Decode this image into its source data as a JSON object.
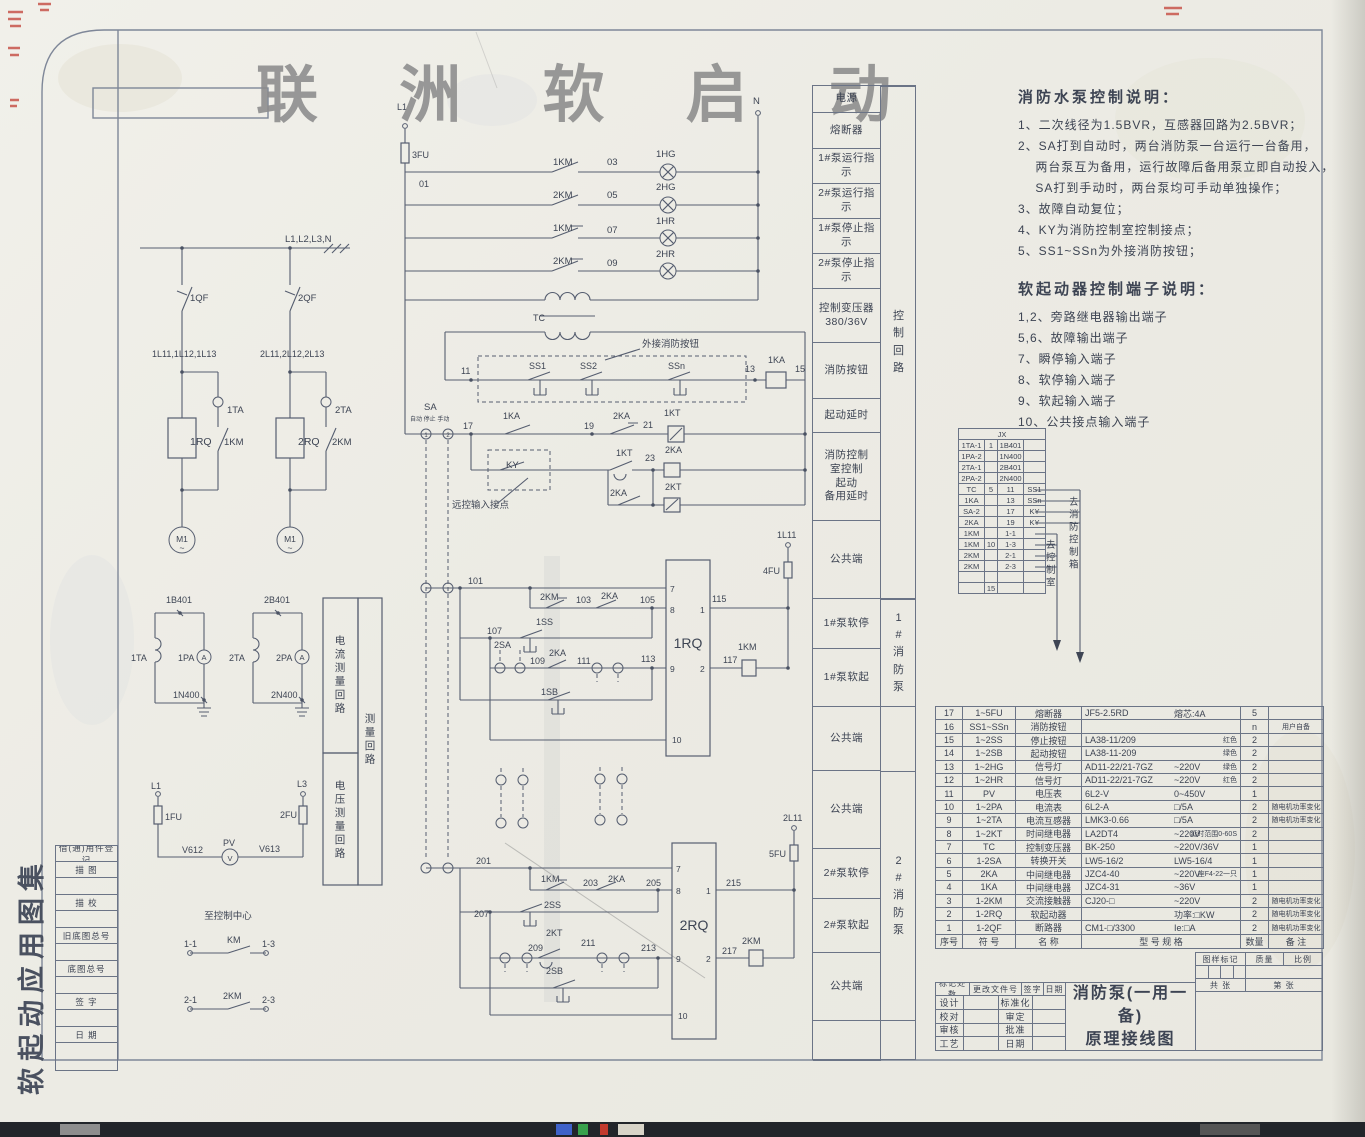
{
  "watermark": "联 洲 软 启 动",
  "side_title": "软起动应用图集",
  "register_rows": [
    "借(通)用件登记",
    "描  图",
    "",
    "描  校",
    "",
    "旧底图总号",
    "",
    "底图总号",
    "",
    "签  字",
    "",
    "日  期",
    ""
  ],
  "labels_column": {
    "rows": [
      "电源",
      "熔断器",
      "1#泵运行指示",
      "2#泵运行指示",
      "1#泵停止指示",
      "2#泵停止指示",
      "控制变压器\n380/36V",
      "消防按钮",
      "起动延时",
      "消防控制\n室控制\n起动\n备用延时",
      "公共端",
      "1#泵软停",
      "1#泵软起",
      "公共端",
      "公共端",
      "2#泵软停",
      "2#泵软起",
      "公共端",
      ""
    ],
    "groups": [
      "控制回路",
      "1#消防泵",
      "2#消防泵"
    ]
  },
  "notes": {
    "heading1": "消防水泵控制说明：",
    "items1": [
      "1、二次线径为1.5BVR，互感器回路为2.5BVR；",
      "2、SA打到自动时，两台消防泵一台运行一台备用，",
      "　  两台泵互为备用，运行故障后备用泵立即自动投入，",
      "　  SA打到手动时，两台泵均可手动单独操作；",
      "3、故障自动复位；",
      "4、KY为消防控制室控制接点；",
      "5、SS1~SSn为外接消防按钮；"
    ],
    "heading2": "软起动器控制端子说明：",
    "items2": [
      "1,2、旁路继电器输出端子",
      "5,6、故障输出端子",
      "7、瞬停输入端子",
      "8、软停输入端子",
      "9、软起输入端子",
      "10、公共接点输入端子"
    ]
  },
  "jx_table": {
    "header": "JX",
    "rows": [
      [
        "1TA-1",
        "1",
        "1B401",
        ""
      ],
      [
        "1PA-2",
        "",
        "1N400",
        ""
      ],
      [
        "2TA-1",
        "",
        "2B401",
        ""
      ],
      [
        "2PA-2",
        "",
        "2N400",
        ""
      ],
      [
        "TC",
        "5",
        "11",
        "SS1"
      ],
      [
        "1KA",
        "",
        "13",
        "SSn"
      ],
      [
        "SA-2",
        "",
        "17",
        "KY"
      ],
      [
        "2KA",
        "",
        "19",
        "KY"
      ],
      [
        "1KM",
        "",
        "1-1",
        ""
      ],
      [
        "1KM",
        "10",
        "1-3",
        ""
      ],
      [
        "2KM",
        "",
        "2-1",
        ""
      ],
      [
        "2KM",
        "",
        "2-3",
        ""
      ],
      [
        "",
        "",
        "",
        ""
      ],
      [
        "",
        "15",
        "",
        ""
      ]
    ]
  },
  "parts_table": {
    "headers": [
      "序号",
      "符  号",
      "名    称",
      "型  号  规  格",
      "数量",
      "备  注"
    ],
    "rows": [
      {
        "no": "17",
        "sym": "1~5FU",
        "name": "熔断器",
        "model": "JF5-2.5RD",
        "spec": "熔芯:4A",
        "extra": "",
        "qty": "5",
        "remark": ""
      },
      {
        "no": "16",
        "sym": "SS1~SSn",
        "name": "消防按钮",
        "model": "",
        "spec": "",
        "extra": "",
        "qty": "n",
        "remark": "用户自备"
      },
      {
        "no": "15",
        "sym": "1~2SS",
        "name": "停止按钮",
        "model": "LA38-11/209",
        "spec": "",
        "extra": "红色",
        "qty": "2",
        "remark": ""
      },
      {
        "no": "14",
        "sym": "1~2SB",
        "name": "起动按钮",
        "model": "LA38-11-209",
        "spec": "",
        "extra": "绿色",
        "qty": "2",
        "remark": ""
      },
      {
        "no": "13",
        "sym": "1~2HG",
        "name": "信号灯",
        "model": "AD11-22/21-7GZ",
        "spec": "~220V",
        "extra": "绿色",
        "qty": "2",
        "remark": ""
      },
      {
        "no": "12",
        "sym": "1~2HR",
        "name": "信号灯",
        "model": "AD11-22/21-7GZ",
        "spec": "~220V",
        "extra": "红色",
        "qty": "2",
        "remark": ""
      },
      {
        "no": "11",
        "sym": "PV",
        "name": "电压表",
        "model": "6L2-V",
        "spec": "0~450V",
        "extra": "",
        "qty": "1",
        "remark": ""
      },
      {
        "no": "10",
        "sym": "1~2PA",
        "name": "电流表",
        "model": "6L2-A",
        "spec": "□/5A",
        "extra": "",
        "qty": "2",
        "remark": "随电机功率变化"
      },
      {
        "no": "9",
        "sym": "1~2TA",
        "name": "电流互感器",
        "model": "LMK3-0.66",
        "spec": "□/5A",
        "extra": "",
        "qty": "2",
        "remark": "随电机功率变化"
      },
      {
        "no": "8",
        "sym": "1~2KT",
        "name": "时间继电器",
        "model": "LA2DT4",
        "spec": "~220V",
        "extra": "延时范围0-60S",
        "qty": "2",
        "remark": ""
      },
      {
        "no": "7",
        "sym": "TC",
        "name": "控制变压器",
        "model": "BK-250",
        "spec": "~220V/36V",
        "extra": "",
        "qty": "1",
        "remark": ""
      },
      {
        "no": "6",
        "sym": "1-2SA",
        "name": "转换开关",
        "model": "LW5-16/2",
        "spec": "LW5-16/4",
        "extra": "",
        "qty": "1",
        "remark": ""
      },
      {
        "no": "5",
        "sym": "2KA",
        "name": "中间继电器",
        "model": "JZC4-40",
        "spec": "~220V",
        "extra": "座F4-22一只",
        "qty": "1",
        "remark": ""
      },
      {
        "no": "4",
        "sym": "1KA",
        "name": "中间继电器",
        "model": "JZC4-31",
        "spec": "~36V",
        "extra": "",
        "qty": "1",
        "remark": ""
      },
      {
        "no": "3",
        "sym": "1-2KM",
        "name": "交流接触器",
        "model": "CJ20-□",
        "spec": "~220V",
        "extra": "",
        "qty": "2",
        "remark": "随电机功率变化"
      },
      {
        "no": "2",
        "sym": "1-2RQ",
        "name": "软起动器",
        "model": "",
        "spec": "功率:□KW",
        "extra": "",
        "qty": "2",
        "remark": "随电机功率变化"
      },
      {
        "no": "1",
        "sym": "1-2QF",
        "name": "断路器",
        "model": "CM1-□/3300",
        "spec": "Ie:□A",
        "extra": "",
        "qty": "2",
        "remark": "随电机功率变化"
      }
    ]
  },
  "title_block": {
    "rev_row": [
      "标记处数",
      "更改文件号",
      "签字",
      "日期"
    ],
    "left_rows": [
      [
        "设计",
        "标准化"
      ],
      [
        "校对",
        "审定"
      ],
      [
        "审核",
        "批准"
      ],
      [
        "工艺",
        "日期"
      ]
    ],
    "title_line1": "消防泵(一用一备)",
    "title_line2": "原理接线图",
    "right_headers": [
      "图样标记",
      "质量",
      "比例"
    ],
    "sheets_total": "共  张",
    "sheets_no": "第  张"
  },
  "schematic": {
    "labels": [
      {
        "x": 285,
        "y": 242,
        "t": "L1,L2,L3,N"
      },
      {
        "x": 190,
        "y": 301,
        "t": "1QF"
      },
      {
        "x": 298,
        "y": 301,
        "t": "2QF"
      },
      {
        "x": 152,
        "y": 357,
        "t": "1L11,1L12,1L13",
        "s": 9
      },
      {
        "x": 260,
        "y": 357,
        "t": "2L11,2L12,2L13",
        "s": 9
      },
      {
        "x": 227,
        "y": 413,
        "t": "1TA"
      },
      {
        "x": 335,
        "y": 413,
        "t": "2TA"
      },
      {
        "x": 190,
        "y": 445,
        "t": "1RQ",
        "s": 10.5
      },
      {
        "x": 224,
        "y": 445,
        "t": "1KM"
      },
      {
        "x": 298,
        "y": 445,
        "t": "2RQ",
        "s": 10.5
      },
      {
        "x": 332,
        "y": 445,
        "t": "2KM"
      },
      {
        "x": 182,
        "y": 542,
        "t": "M1",
        "s": 8.5,
        "a": "m"
      },
      {
        "x": 182,
        "y": 551,
        "t": "~",
        "s": 8.5,
        "a": "m"
      },
      {
        "x": 290,
        "y": 542,
        "t": "M1",
        "s": 8.5,
        "a": "m"
      },
      {
        "x": 290,
        "y": 551,
        "t": "~",
        "s": 8.5,
        "a": "m"
      },
      {
        "x": 166,
        "y": 603,
        "t": "1B401",
        "s": 9
      },
      {
        "x": 264,
        "y": 603,
        "t": "2B401",
        "s": 9
      },
      {
        "x": 131,
        "y": 661,
        "t": "1TA",
        "s": 9
      },
      {
        "x": 229,
        "y": 661,
        "t": "2TA",
        "s": 9
      },
      {
        "x": 178,
        "y": 661,
        "t": "1PA",
        "s": 9
      },
      {
        "x": 276,
        "y": 661,
        "t": "2PA",
        "s": 9
      },
      {
        "x": 204,
        "y": 660,
        "t": "A",
        "s": 7.5,
        "a": "m"
      },
      {
        "x": 302,
        "y": 660,
        "t": "A",
        "s": 7.5,
        "a": "m"
      },
      {
        "x": 173,
        "y": 698,
        "t": "1N400",
        "s": 9
      },
      {
        "x": 271,
        "y": 698,
        "t": "2N400",
        "s": 9
      },
      {
        "x": 151,
        "y": 789,
        "t": "L1",
        "s": 9
      },
      {
        "x": 297,
        "y": 787,
        "t": "L3",
        "s": 9
      },
      {
        "x": 165,
        "y": 820,
        "t": "1FU",
        "s": 9
      },
      {
        "x": 280,
        "y": 818,
        "t": "2FU",
        "s": 9
      },
      {
        "x": 182,
        "y": 853,
        "t": "V612",
        "s": 9
      },
      {
        "x": 259,
        "y": 852,
        "t": "V613",
        "s": 9
      },
      {
        "x": 223,
        "y": 846,
        "t": "PV",
        "s": 9
      },
      {
        "x": 230,
        "y": 861,
        "t": "V",
        "s": 7.5,
        "a": "m"
      },
      {
        "x": 340,
        "y": 644,
        "t": "电流测量回路",
        "s": 10.5,
        "a": "m",
        "v": 1
      },
      {
        "x": 340,
        "y": 789,
        "t": "电压测量回路",
        "s": 10.5,
        "a": "m",
        "v": 1
      },
      {
        "x": 370,
        "y": 722,
        "t": "测量回路",
        "s": 10.5,
        "a": "m",
        "v": 1
      },
      {
        "x": 228,
        "y": 919,
        "t": "至控制中心",
        "s": 9.5,
        "a": "m"
      },
      {
        "x": 184,
        "y": 947,
        "t": "1-1",
        "s": 9
      },
      {
        "x": 227,
        "y": 943,
        "t": "KM",
        "s": 9
      },
      {
        "x": 262,
        "y": 947,
        "t": "1-3",
        "s": 9
      },
      {
        "x": 184,
        "y": 1003,
        "t": "2-1",
        "s": 9
      },
      {
        "x": 223,
        "y": 999,
        "t": "2KM",
        "s": 9
      },
      {
        "x": 262,
        "y": 1003,
        "t": "2-3",
        "s": 9
      },
      {
        "x": 397,
        "y": 110,
        "t": "L1",
        "s": 9
      },
      {
        "x": 753,
        "y": 104,
        "t": "N",
        "s": 9.5
      },
      {
        "x": 412,
        "y": 158,
        "t": "3FU",
        "s": 9
      },
      {
        "x": 419,
        "y": 187,
        "t": "01",
        "s": 9
      },
      {
        "x": 553,
        "y": 165,
        "t": "1KM"
      },
      {
        "x": 607,
        "y": 165,
        "t": "03"
      },
      {
        "x": 656,
        "y": 157,
        "t": "1HG"
      },
      {
        "x": 553,
        "y": 198,
        "t": "2KM"
      },
      {
        "x": 607,
        "y": 198,
        "t": "05"
      },
      {
        "x": 656,
        "y": 190,
        "t": "2HG"
      },
      {
        "x": 553,
        "y": 231,
        "t": "1KM"
      },
      {
        "x": 607,
        "y": 233,
        "t": "07"
      },
      {
        "x": 656,
        "y": 224,
        "t": "1HR"
      },
      {
        "x": 553,
        "y": 264,
        "t": "2KM"
      },
      {
        "x": 607,
        "y": 266,
        "t": "09"
      },
      {
        "x": 656,
        "y": 257,
        "t": "2HR"
      },
      {
        "x": 533,
        "y": 321,
        "t": "TC",
        "s": 9
      },
      {
        "x": 642,
        "y": 347,
        "t": "外接消防按钮",
        "s": 9.5
      },
      {
        "x": 461,
        "y": 374,
        "t": "11",
        "s": 9
      },
      {
        "x": 529,
        "y": 369,
        "t": "SS1",
        "s": 9
      },
      {
        "x": 580,
        "y": 369,
        "t": "SS2",
        "s": 9
      },
      {
        "x": 668,
        "y": 369,
        "t": "SSn",
        "s": 9
      },
      {
        "x": 745,
        "y": 372,
        "t": "13",
        "s": 9
      },
      {
        "x": 768,
        "y": 363,
        "t": "1KA",
        "s": 9
      },
      {
        "x": 795,
        "y": 372,
        "t": "15",
        "s": 9
      },
      {
        "x": 424,
        "y": 410,
        "t": "SA",
        "s": 9.5
      },
      {
        "x": 410,
        "y": 421,
        "t": "自动 停止 手动",
        "s": 6
      },
      {
        "x": 463,
        "y": 429,
        "t": "17",
        "s": 9
      },
      {
        "x": 503,
        "y": 419,
        "t": "1KA",
        "s": 9
      },
      {
        "x": 584,
        "y": 429,
        "t": "19",
        "s": 9
      },
      {
        "x": 613,
        "y": 419,
        "t": "2KA",
        "s": 9
      },
      {
        "x": 643,
        "y": 428,
        "t": "21",
        "s": 9
      },
      {
        "x": 664,
        "y": 416,
        "t": "1KT",
        "s": 9
      },
      {
        "x": 506,
        "y": 468,
        "t": "KY",
        "s": 9.5
      },
      {
        "x": 616,
        "y": 456,
        "t": "1KT",
        "s": 9
      },
      {
        "x": 645,
        "y": 461,
        "t": "23",
        "s": 9
      },
      {
        "x": 665,
        "y": 453,
        "t": "2KA",
        "s": 9
      },
      {
        "x": 610,
        "y": 496,
        "t": "2KA",
        "s": 9
      },
      {
        "x": 665,
        "y": 490,
        "t": "2KT",
        "s": 9
      },
      {
        "x": 452,
        "y": 508,
        "t": "远控输入接点",
        "s": 9.5
      },
      {
        "x": 777,
        "y": 538,
        "t": "1L11",
        "s": 9
      },
      {
        "x": 763,
        "y": 574,
        "t": "4FU",
        "s": 9
      },
      {
        "x": 468,
        "y": 584,
        "t": "101",
        "s": 9
      },
      {
        "x": 540,
        "y": 600,
        "t": "2KM",
        "s": 9
      },
      {
        "x": 576,
        "y": 603,
        "t": "103",
        "s": 9
      },
      {
        "x": 601,
        "y": 599,
        "t": "2KA",
        "s": 9
      },
      {
        "x": 640,
        "y": 603,
        "t": "105",
        "s": 9
      },
      {
        "x": 536,
        "y": 625,
        "t": "1SS",
        "s": 9
      },
      {
        "x": 487,
        "y": 634,
        "t": "107",
        "s": 9
      },
      {
        "x": 494,
        "y": 648,
        "t": "2SA",
        "s": 9
      },
      {
        "x": 530,
        "y": 664,
        "t": "109",
        "s": 9
      },
      {
        "x": 549,
        "y": 656,
        "t": "2KA",
        "s": 9
      },
      {
        "x": 577,
        "y": 664,
        "t": "111",
        "s": 9
      },
      {
        "x": 641,
        "y": 662,
        "t": "113",
        "s": 9
      },
      {
        "x": 541,
        "y": 695,
        "t": "1SB",
        "s": 9
      },
      {
        "x": 670,
        "y": 592,
        "t": "7",
        "s": 8.5
      },
      {
        "x": 670,
        "y": 613,
        "t": "8",
        "s": 8.5
      },
      {
        "x": 700,
        "y": 613,
        "t": "1",
        "s": 8.5
      },
      {
        "x": 670,
        "y": 672,
        "t": "9",
        "s": 8.5
      },
      {
        "x": 700,
        "y": 672,
        "t": "2",
        "s": 8.5
      },
      {
        "x": 672,
        "y": 743,
        "t": "10",
        "s": 8.5
      },
      {
        "x": 688,
        "y": 648,
        "t": "1RQ",
        "s": 14,
        "a": "m"
      },
      {
        "x": 712,
        "y": 602,
        "t": "115",
        "s": 9
      },
      {
        "x": 723,
        "y": 663,
        "t": "117",
        "s": 9
      },
      {
        "x": 738,
        "y": 650,
        "t": "1KM",
        "s": 9
      },
      {
        "x": 783,
        "y": 821,
        "t": "2L11",
        "s": 9
      },
      {
        "x": 769,
        "y": 857,
        "t": "5FU",
        "s": 9
      },
      {
        "x": 476,
        "y": 864,
        "t": "201",
        "s": 9
      },
      {
        "x": 541,
        "y": 882,
        "t": "1KM",
        "s": 9
      },
      {
        "x": 583,
        "y": 886,
        "t": "203",
        "s": 9
      },
      {
        "x": 608,
        "y": 882,
        "t": "2KA",
        "s": 9
      },
      {
        "x": 646,
        "y": 886,
        "t": "205",
        "s": 9
      },
      {
        "x": 544,
        "y": 908,
        "t": "2SS",
        "s": 9
      },
      {
        "x": 474,
        "y": 917,
        "t": "207",
        "s": 9
      },
      {
        "x": 546,
        "y": 936,
        "t": "2KT",
        "s": 9
      },
      {
        "x": 528,
        "y": 951,
        "t": "209",
        "s": 9
      },
      {
        "x": 581,
        "y": 946,
        "t": "211",
        "s": 9
      },
      {
        "x": 641,
        "y": 951,
        "t": "213",
        "s": 9
      },
      {
        "x": 546,
        "y": 974,
        "t": "2SB",
        "s": 9
      },
      {
        "x": 676,
        "y": 872,
        "t": "7",
        "s": 8.5
      },
      {
        "x": 676,
        "y": 894,
        "t": "8",
        "s": 8.5
      },
      {
        "x": 706,
        "y": 894,
        "t": "1",
        "s": 8.5
      },
      {
        "x": 676,
        "y": 962,
        "t": "9",
        "s": 8.5
      },
      {
        "x": 706,
        "y": 962,
        "t": "2",
        "s": 8.5
      },
      {
        "x": 678,
        "y": 1019,
        "t": "10",
        "s": 8.5
      },
      {
        "x": 694,
        "y": 930,
        "t": "2RQ",
        "s": 14,
        "a": "m"
      },
      {
        "x": 726,
        "y": 886,
        "t": "215",
        "s": 9
      },
      {
        "x": 722,
        "y": 954,
        "t": "217",
        "s": 9
      },
      {
        "x": 742,
        "y": 944,
        "t": "2KM",
        "s": 9
      },
      {
        "x": 426,
        "y": 437,
        "t": "1",
        "s": 6,
        "a": "m"
      },
      {
        "x": 448,
        "y": 437,
        "t": "2",
        "s": 6,
        "a": "m"
      },
      {
        "x": 1046,
        "y": 548,
        "t": "去控制室",
        "s": 9.5,
        "v": 1
      },
      {
        "x": 1069,
        "y": 505,
        "t": "去消防控制箱",
        "s": 9.5,
        "v": 1
      }
    ]
  }
}
